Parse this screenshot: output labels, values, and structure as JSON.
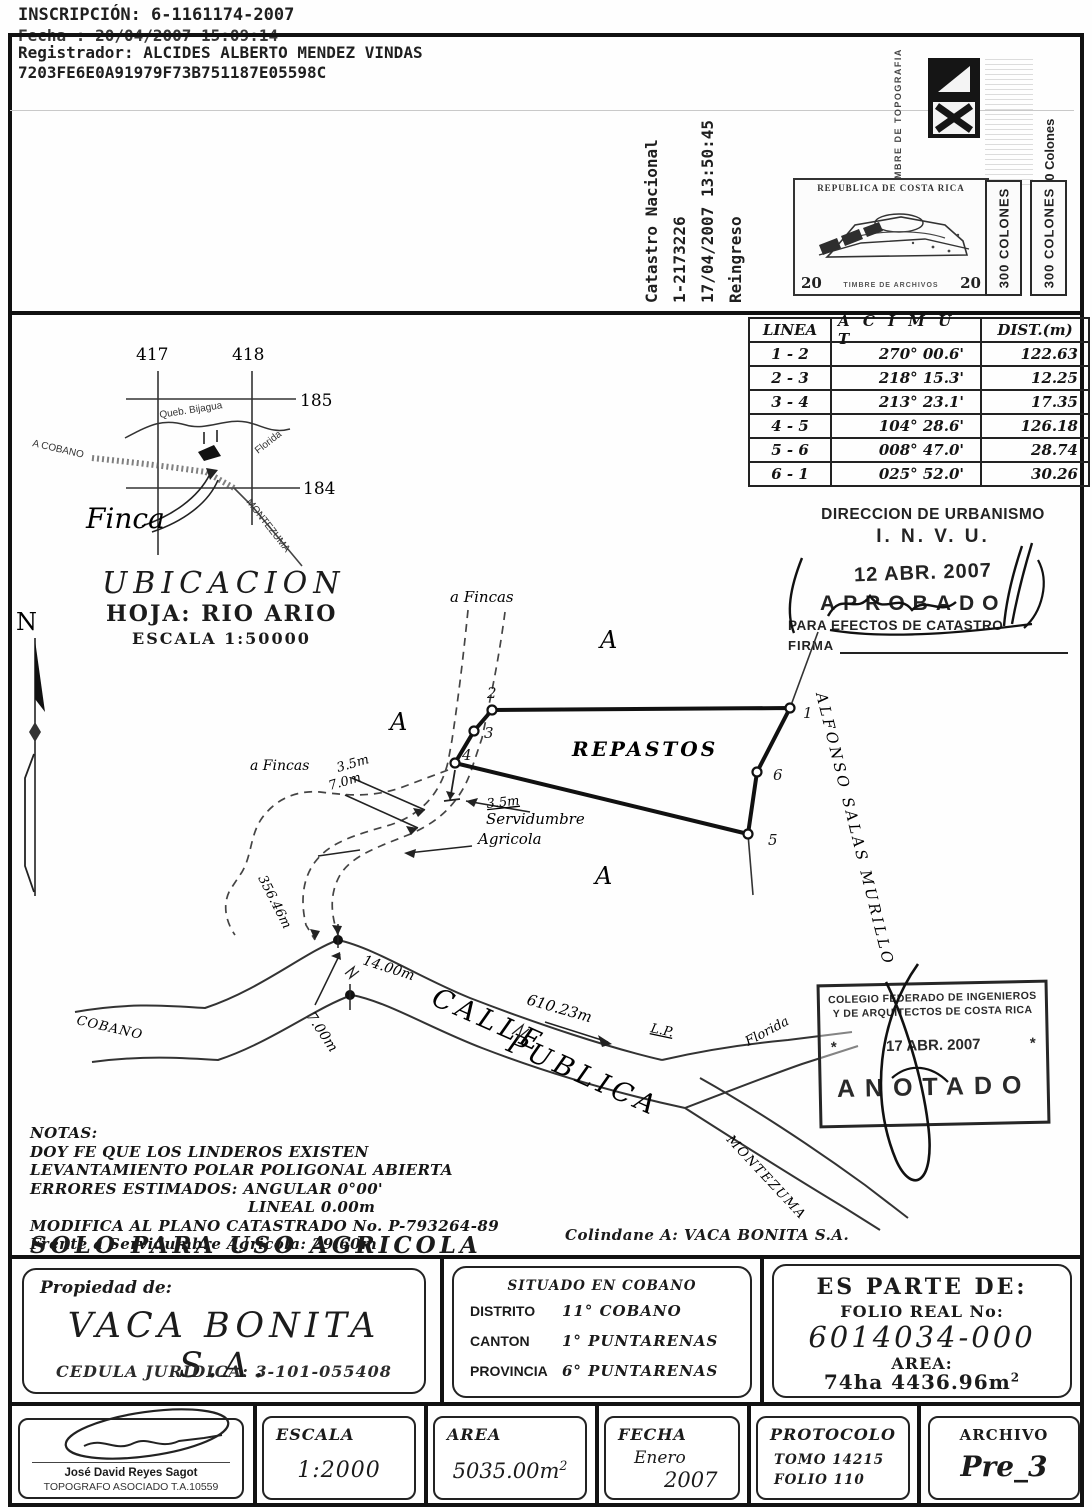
{
  "header": {
    "inscripcion": "INSCRIPCIÓN: 6-1161174-2007",
    "fecha": "Fecha      : 20/04/2007 15:09:14",
    "registrador": "Registrador: ALCIDES ALBERTO MENDEZ VINDAS",
    "hash": "7203FE6E0A91979F73B751187E05598C"
  },
  "catastro": {
    "line1": "Catastro Nacional",
    "line2": "1-2173226",
    "line3": "17/04/2007 13:50:45",
    "line4": "Reingreso"
  },
  "stamps": {
    "topografia_title": "TIMBRE DE TOPOGRAFIA",
    "topografia_value": "10 Colones",
    "archivos_country": "REPUBLICA DE COSTA RICA",
    "archivos_denom_left": "20",
    "archivos_denom_right": "20",
    "archivos_caption": "TIMBRE DE ARCHIVOS",
    "colones_1": "300 COLONES",
    "colones_2": "300 COLONES"
  },
  "survey_table": {
    "headers": [
      "LINEA",
      "A C I M U T",
      "DIST.(m)"
    ],
    "rows": [
      [
        "1 - 2",
        "270° 00.6'",
        "122.63"
      ],
      [
        "2 - 3",
        "218° 15.3'",
        "12.25"
      ],
      [
        "3 - 4",
        "213° 23.1'",
        "17.35"
      ],
      [
        "4 - 5",
        "104° 28.6'",
        "126.18"
      ],
      [
        "5 - 6",
        "008° 47.0'",
        "28.74"
      ],
      [
        "6 - 1",
        "025° 52.0'",
        "30.26"
      ]
    ]
  },
  "ubicacion": {
    "grid_417": "417",
    "grid_418": "418",
    "grid_185": "185",
    "grid_184": "184",
    "creek": "Queb. Bijagua",
    "a_cobano": "A COBANO",
    "florida": "Florida",
    "montezuma": "MONTEZUMA",
    "finca": "Finca",
    "title": "UBICACION",
    "hoja": "HOJA: RIO ARIO",
    "escala": "ESCALA 1:50000",
    "north": "N"
  },
  "invu": {
    "line1": "DIRECCION DE URBANISMO",
    "line2": "I. N. V. U.",
    "date": "12 ABR. 2007",
    "aprobado": "APROBADO",
    "line3": "PARA EFECTOS DE CATASTRO",
    "firma": "FIRMA"
  },
  "plot": {
    "a_fincas_top": "a Fincas",
    "a_fincas_left": "a Fincas",
    "adj_a1": "A",
    "adj_a2": "A",
    "adj_a3": "A",
    "repastos": "REPASTOS",
    "v1": "1",
    "v2": "2",
    "v3": "3",
    "v4": "4",
    "v5": "5",
    "v6": "6",
    "dim_35_left": "3.5m",
    "dim_70_left": "7.0m",
    "dim_35_right": "3.5m",
    "servidumbre_1": "Servidumbre",
    "servidumbre_2": "Agricola",
    "dist_356": "356.46m",
    "dist_14": "14.00m",
    "dist_7": "7.00m",
    "dist_610": "610.23m",
    "lp": "L.P.",
    "cobano": "COBANO",
    "calle": "CALLE",
    "publica": "PUBLICA",
    "florida": "Florida",
    "montezuma": "MONTEZUMA",
    "owner_east": "ALFONSO SALAS MURILLO"
  },
  "colegio": {
    "line1": "COLEGIO FEDERADO DE INGENIEROS",
    "line2": "Y DE ARQUITECTOS DE COSTA RICA",
    "star_left": "*",
    "date": "17 ABR. 2007",
    "star_right": "*",
    "anotado": "ANOTADO"
  },
  "notes": {
    "title": "NOTAS:",
    "line1": "DOY FE QUE LOS LINDEROS EXISTEN",
    "line2": "LEVANTAMIENTO POLAR POLIGONAL ABIERTA",
    "line3": "ERRORES ESTIMADOS: ANGULAR 0°00'",
    "line4": "LINEAL 0.00m",
    "line5": "MODIFICA AL PLANO CATASTRADO No. P-793264-89",
    "line6": "Frente a Servidumbre Agricola: 29.60m",
    "solo": "SOLO PARA USO AGRICOLA",
    "colindante": "Colindane A: VACA BONITA S.A."
  },
  "propiedad": {
    "label": "Propiedad de:",
    "owner": "VACA BONITA S.A.",
    "cedula": "CEDULA JURIDICA: 3-101-055408"
  },
  "situado": {
    "line1": "SITUADO EN COBANO",
    "distrito_label": "DISTRITO",
    "distrito_value": "11° COBANO",
    "canton_label": "CANTON",
    "canton_value": "1° PUNTARENAS",
    "provincia_label": "PROVINCIA",
    "provincia_value": "6° PUNTARENAS"
  },
  "es_parte": {
    "title": "ES PARTE DE:",
    "folio_label": "FOLIO REAL No:",
    "folio": "6014034-000",
    "area_label": "AREA:",
    "area": "74ha 4436.96m",
    "area_sup": "2"
  },
  "footer": {
    "surveyor_name": "José David Reyes Sagot",
    "surveyor_title": "TOPOGRAFO ASOCIADO T.A.10559",
    "escala_label": "ESCALA",
    "escala_value": "1:2000",
    "area_label": "AREA",
    "area_value": "5035.00m",
    "area_sup": "2",
    "fecha_label": "FECHA",
    "fecha_month": "Enero",
    "fecha_year": "2007",
    "protocolo_label": "PROTOCOLO",
    "protocolo_tomo": "TOMO 14215",
    "protocolo_folio": "FOLIO 110",
    "archivo_label": "ARCHIVO",
    "archivo_value": "Pre_3"
  }
}
